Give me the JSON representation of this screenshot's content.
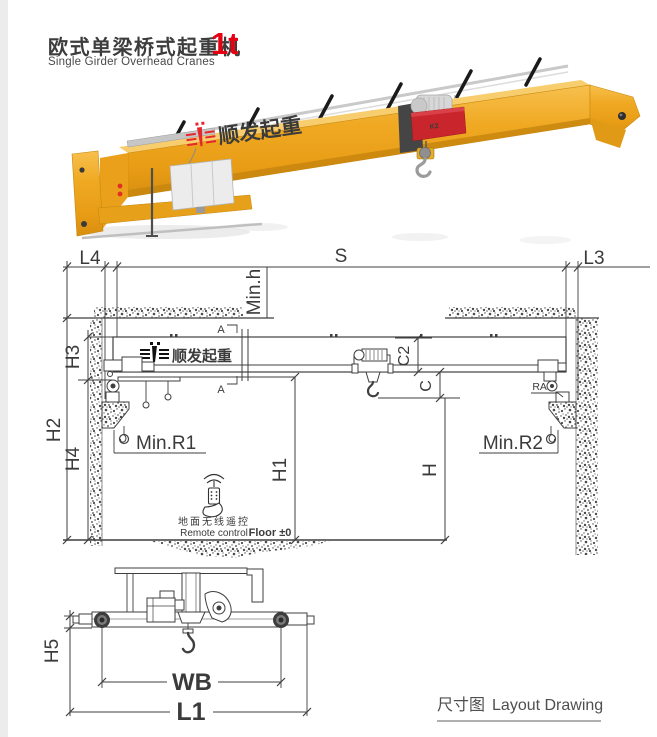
{
  "header": {
    "title_cn": "欧式单梁桥式起重机",
    "title_en": "Single Girder Overhead Cranes",
    "capacity": "1t"
  },
  "render3d": {
    "girder_logo": "顺发起重",
    "hoist_label": "K2",
    "colors": {
      "girder_yellow": "#efa91f",
      "hoist_red": "#c9252c",
      "logo_red": "#e8262d"
    }
  },
  "layout_drawing": {
    "labels": {
      "l4": "L4",
      "s": "S",
      "l3": "L3",
      "min_h": "Min.h",
      "h2": "H2",
      "h3": "H3",
      "h4": "H4",
      "h1": "H1",
      "h": "H",
      "c2": "C2",
      "c": "C",
      "min_r1": "Min.R1",
      "min_r2": "Min.R2",
      "rail": "RAIL",
      "section_a_top": "A",
      "section_a_bottom": "A"
    },
    "girder_logo": "顺发起重",
    "remote_cn": "地面无线遥控",
    "remote_en": "Remote control",
    "floor_label": "Floor ±0"
  },
  "end_view": {
    "h5": "H5",
    "wb": "WB",
    "l1": "L1"
  },
  "footer": {
    "caption_cn": "尺寸图",
    "caption_en": "Layout Drawing"
  }
}
